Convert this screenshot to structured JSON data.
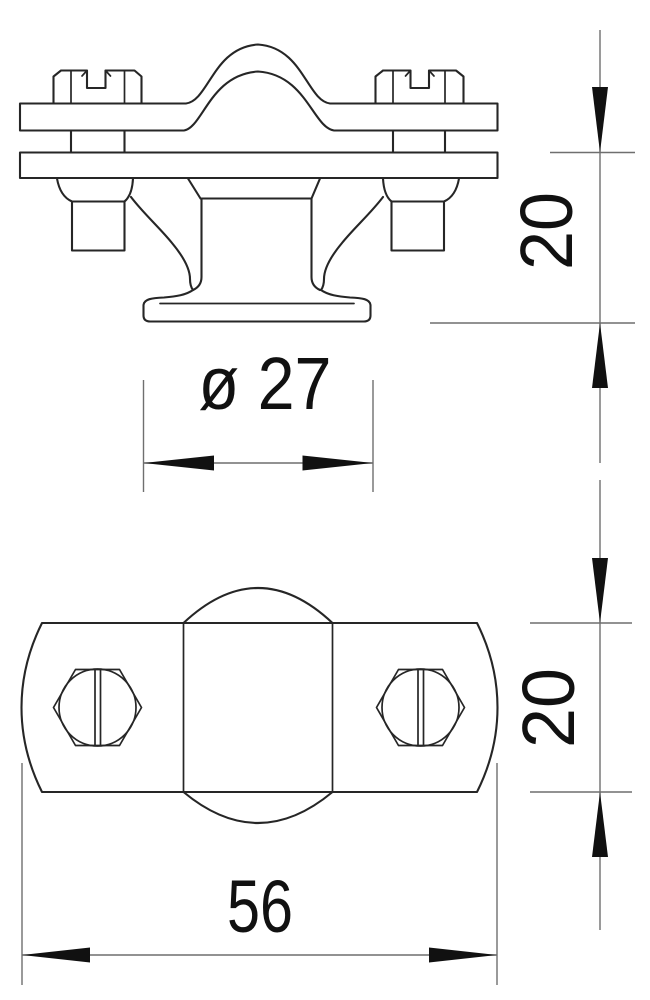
{
  "drawing": {
    "type": "technical-drawing",
    "part": "pipe spacer clip with saddle clamp, two slotted screws and trumpet base",
    "background_color": "#ffffff",
    "outline_color": "#262626",
    "dimension_line_color": "#6f6f6f",
    "text_color": "#111111",
    "views": {
      "side_view": "front elevation (upper figure)",
      "top_view": "plan view (lower figure)"
    },
    "dimensions": {
      "diameter": "ø 27",
      "upper_height": "20",
      "lower_height": "20",
      "width": "56"
    }
  }
}
